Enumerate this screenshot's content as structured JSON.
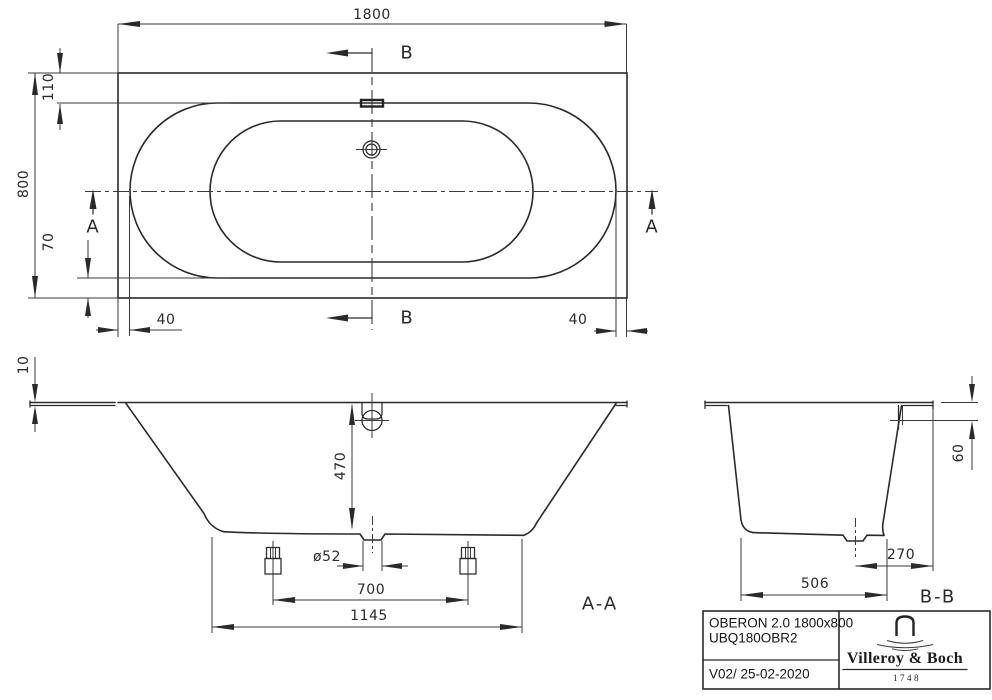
{
  "colors": {
    "line": "#2a2a2a",
    "background": "#ffffff"
  },
  "plan": {
    "dim_overall_length": "1800",
    "dim_overall_width": "800",
    "dim_rim_top": "110",
    "dim_rim_bottom": "70",
    "dim_rim_left": "40",
    "dim_rim_right": "40",
    "section_a": "A",
    "section_b": "B"
  },
  "section_aa": {
    "label": "A-A",
    "dim_rim_thickness": "10",
    "dim_inner_depth": "470",
    "dim_drain_diameter": "ø52",
    "dim_feet_spacing": "700",
    "dim_support_length": "1145"
  },
  "section_bb": {
    "label": "B-B",
    "dim_rim_height": "60",
    "dim_drain_offset": "270",
    "dim_bottom_width": "506"
  },
  "title_block": {
    "product": "OBERON 2.0 1800x800",
    "article": "UBQ180OBR2",
    "version": "V02/ 25-02-2020",
    "brand": "Villeroy & Boch",
    "established": "1748"
  }
}
